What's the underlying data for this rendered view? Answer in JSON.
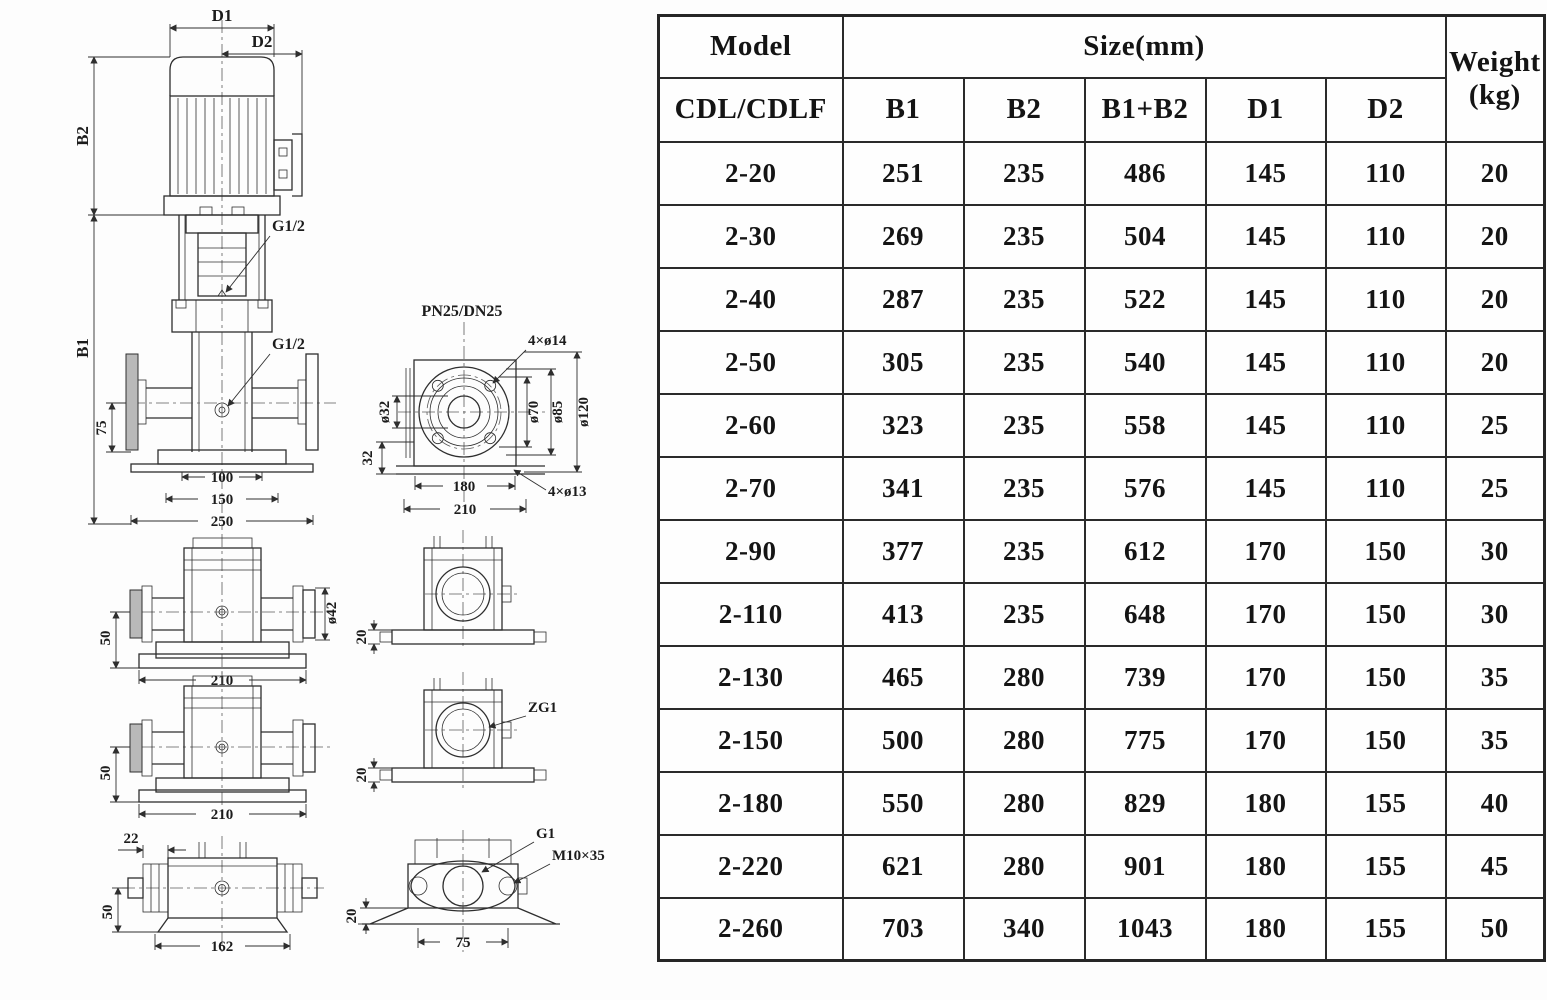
{
  "table": {
    "header": {
      "model": "Model",
      "model_sub": "CDL/CDLF",
      "size_group": "Size(mm)",
      "size_cols": [
        "B1",
        "B2",
        "B1+B2",
        "D1",
        "D2"
      ],
      "weight_line1": "Weight",
      "weight_line2": "(kg)"
    },
    "rows": [
      {
        "model": "2-20",
        "b1": "251",
        "b2": "235",
        "b1b2": "486",
        "d1": "145",
        "d2": "110",
        "kg": "20"
      },
      {
        "model": "2-30",
        "b1": "269",
        "b2": "235",
        "b1b2": "504",
        "d1": "145",
        "d2": "110",
        "kg": "20"
      },
      {
        "model": "2-40",
        "b1": "287",
        "b2": "235",
        "b1b2": "522",
        "d1": "145",
        "d2": "110",
        "kg": "20"
      },
      {
        "model": "2-50",
        "b1": "305",
        "b2": "235",
        "b1b2": "540",
        "d1": "145",
        "d2": "110",
        "kg": "20"
      },
      {
        "model": "2-60",
        "b1": "323",
        "b2": "235",
        "b1b2": "558",
        "d1": "145",
        "d2": "110",
        "kg": "25"
      },
      {
        "model": "2-70",
        "b1": "341",
        "b2": "235",
        "b1b2": "576",
        "d1": "145",
        "d2": "110",
        "kg": "25"
      },
      {
        "model": "2-90",
        "b1": "377",
        "b2": "235",
        "b1b2": "612",
        "d1": "170",
        "d2": "150",
        "kg": "30"
      },
      {
        "model": "2-110",
        "b1": "413",
        "b2": "235",
        "b1b2": "648",
        "d1": "170",
        "d2": "150",
        "kg": "30"
      },
      {
        "model": "2-130",
        "b1": "465",
        "b2": "280",
        "b1b2": "739",
        "d1": "170",
        "d2": "150",
        "kg": "35"
      },
      {
        "model": "2-150",
        "b1": "500",
        "b2": "280",
        "b1b2": "775",
        "d1": "170",
        "d2": "150",
        "kg": "35"
      },
      {
        "model": "2-180",
        "b1": "550",
        "b2": "280",
        "b1b2": "829",
        "d1": "180",
        "d2": "155",
        "kg": "40"
      },
      {
        "model": "2-220",
        "b1": "621",
        "b2": "280",
        "b1b2": "901",
        "d1": "180",
        "d2": "155",
        "kg": "45"
      },
      {
        "model": "2-260",
        "b1": "703",
        "b2": "340",
        "b1b2": "1043",
        "d1": "180",
        "d2": "155",
        "kg": "50"
      }
    ]
  },
  "drawing": {
    "front": {
      "d1": "D1",
      "d2": "D2",
      "b2": "B2",
      "b1": "B1",
      "g12_top": "G1/2",
      "g12_mid": "G1/2",
      "dim75": "75",
      "dim100": "100",
      "dim150": "150",
      "dim250": "250"
    },
    "flange": {
      "title": "PN25/DN25",
      "holes_top": "4×ø14",
      "bore": "ø32",
      "d70": "ø70",
      "d85": "ø85",
      "d120": "ø120",
      "dim32": "32",
      "dim180": "180",
      "dim210": "210",
      "holes_bottom": "4×ø13"
    },
    "side_top": {
      "dim50": "50",
      "dim210": "210",
      "d42": "ø42"
    },
    "side_mid": {
      "dim50": "50",
      "dim210": "210"
    },
    "side_bottom": {
      "dim22": "22",
      "dim50": "50",
      "dim162": "162"
    },
    "port_top": {
      "dim20": "20"
    },
    "port_mid": {
      "label": "ZG1",
      "dim20": "20"
    },
    "port_bottom": {
      "g1": "G1",
      "bolt": "M10×35",
      "dim20": "20",
      "dim75": "75"
    }
  }
}
